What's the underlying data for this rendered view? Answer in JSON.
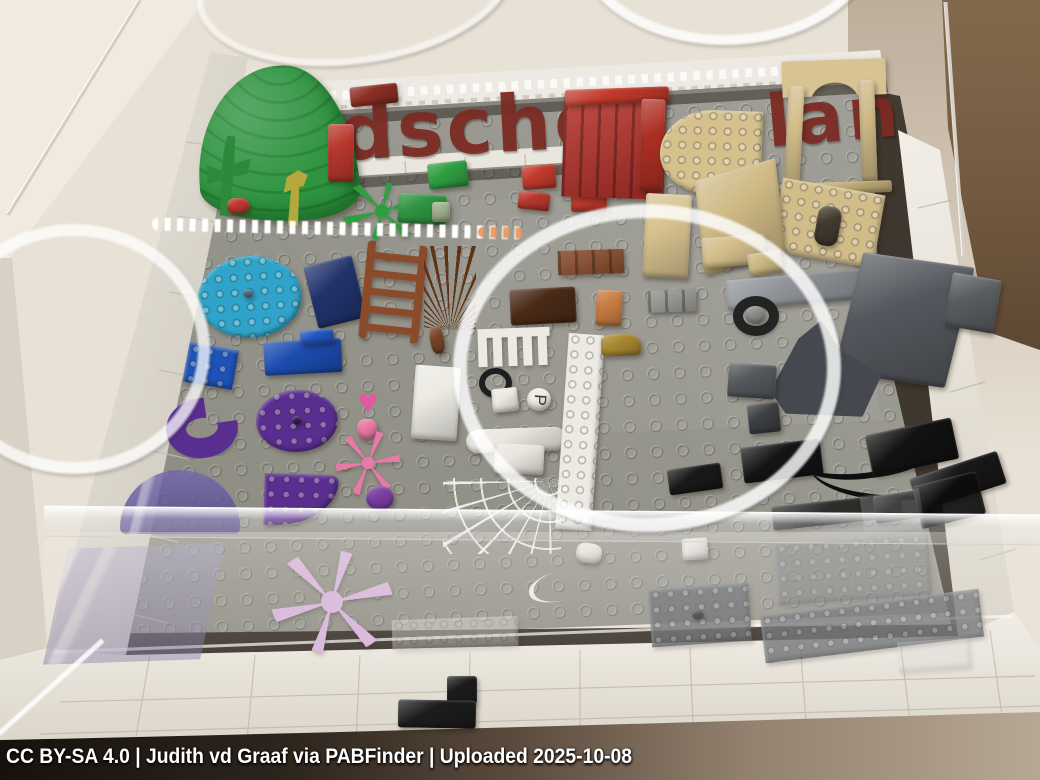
{
  "description": "Photograph of a LEGO Pick-a-Brick idea display table: a clear acrylic case over a gray studded baseplate framed in white bricks, holding loose LEGO elements grouped by color (green, red, tan, brown, blue, purple, pink, white, gray, black). Dark-red brick-built letters run along the back. Ceiling lights reflect as white rings on the acrylic.",
  "caption": {
    "text": "CC BY-SA 4.0 | Judith vd Graaf via PABFinder | Uploaded 2025-10-08"
  },
  "mosaic_letters": {
    "left": "dsche",
    "right": "lan",
    "color": "#7b2b22"
  },
  "palette": {
    "wall": "#e8e1d5",
    "wall_light": "#f0eadf",
    "apron": "#ece8e0",
    "apron_shade": "#d8d2c6",
    "baseplate": "#98978f",
    "baseplate_dark": "#86857c",
    "trench": "#342c23",
    "box_brown": "#7b6247",
    "box_brown_dark": "#573f2c",
    "border_white": "#edeae3",
    "acrylic_edge": "#d2cdc4",
    "floor_shadow": "#17120e",
    "floor_shadow_light": "#b7a795",
    "ring": "rgba(255,255,255,0.8)",
    "letters": "#7b2b22"
  },
  "acrylic_bar": {
    "x": 44,
    "y": 510,
    "w": 996,
    "h": 28,
    "haze_h": 130
  },
  "pieces": [
    {
      "name": "green-leaf-canopy",
      "kind": "dome",
      "x": 197,
      "y": 66,
      "w": 160,
      "h": 156,
      "c": "#2e9440",
      "r": "55% 45% 35% 65% / 75% 85% 18% 25%",
      "rot": -4
    },
    {
      "name": "green-cactus",
      "kind": "clip",
      "x": 206,
      "y": 136,
      "w": 44,
      "h": 80,
      "c": "#2c8a3a",
      "clip": "polygon(42% 0,60% 0,62% 34%,100% 26%,94% 46%,62% 50%,60% 100%,38% 100%,36% 56%,4% 62%,0 38%,34% 44%,38% 12%)",
      "rot": 4
    },
    {
      "name": "red-flower-piece",
      "kind": "block",
      "x": 227,
      "y": 198,
      "w": 22,
      "h": 16,
      "c": "#bf3b2d",
      "r": "40%"
    },
    {
      "name": "olive-sprout",
      "kind": "clip",
      "x": 277,
      "y": 170,
      "w": 36,
      "h": 56,
      "c": "#b5a93e",
      "clip": "polygon(55% 0,82% 8%,72% 28%,60% 30%,62% 100%,34% 100%,38% 36%,18% 42%,24% 14%)",
      "rot": 3
    },
    {
      "name": "green-plant-plate",
      "kind": "snow",
      "x": 340,
      "y": 182,
      "w": 84,
      "h": 58,
      "c": "#2f9e41",
      "rot": 8
    },
    {
      "name": "green-slope-brick",
      "kind": "block",
      "x": 428,
      "y": 162,
      "w": 40,
      "h": 26,
      "c": "#2f9e41",
      "rot": -6
    },
    {
      "name": "green-plate-cluster",
      "kind": "block",
      "x": 398,
      "y": 194,
      "w": 48,
      "h": 30,
      "c": "#2e9440",
      "rot": 4
    },
    {
      "name": "sand-green-brick",
      "kind": "block",
      "x": 432,
      "y": 202,
      "w": 18,
      "h": 20,
      "c": "#9fb08c"
    },
    {
      "name": "dark-red-plate",
      "kind": "block",
      "x": 350,
      "y": 85,
      "w": 48,
      "h": 20,
      "c": "#8a2f24",
      "rot": -6
    },
    {
      "name": "red-brick-stack-left",
      "kind": "block",
      "x": 328,
      "y": 124,
      "w": 26,
      "h": 58,
      "c": "#b7372b"
    },
    {
      "name": "red-slope-brick",
      "kind": "block",
      "x": 522,
      "y": 165,
      "w": 34,
      "h": 24,
      "c": "#c03a2c",
      "rot": -4
    },
    {
      "name": "red-small-bricks",
      "kind": "block",
      "x": 518,
      "y": 192,
      "w": 32,
      "h": 18,
      "c": "#b7372b",
      "rot": 6
    },
    {
      "name": "red-2x2-brick",
      "kind": "block",
      "x": 571,
      "y": 186,
      "w": 36,
      "h": 26,
      "c": "#c03a2c"
    },
    {
      "name": "red-panel-wall",
      "kind": "wall",
      "x": 563,
      "y": 96,
      "w": 102,
      "h": 102,
      "c": "#b52f27",
      "rot": 2
    },
    {
      "name": "red-wall-top-brick",
      "kind": "block",
      "x": 565,
      "y": 88,
      "w": 104,
      "h": 16,
      "c": "#c23a2b",
      "rot": -2
    },
    {
      "name": "red-brick-stack-right",
      "kind": "block",
      "x": 640,
      "y": 99,
      "w": 24,
      "h": 92,
      "c": "#ad2f24",
      "rot": 2
    },
    {
      "name": "tan-quarter-circle-plate",
      "kind": "flat",
      "x": 660,
      "y": 110,
      "w": 102,
      "h": 84,
      "c": "#d6c18e",
      "r": "100% 0 0 90%",
      "rot": 2,
      "studs": true
    },
    {
      "name": "tan-arch-lintel",
      "kind": "archtop",
      "x": 782,
      "y": 60,
      "w": 104,
      "h": 36,
      "c": "#d8c392",
      "rot": -2
    },
    {
      "name": "tan-arch-leg-left",
      "kind": "block",
      "x": 786,
      "y": 86,
      "w": 16,
      "h": 106,
      "c": "#d2bd8a",
      "rot": 3
    },
    {
      "name": "tan-arch-leg-right",
      "kind": "block",
      "x": 860,
      "y": 80,
      "w": 16,
      "h": 102,
      "c": "#cdb884",
      "rot": -2
    },
    {
      "name": "tan-arch-base-plate",
      "kind": "block",
      "x": 780,
      "y": 182,
      "w": 112,
      "h": 12,
      "c": "#cbb680",
      "rot": -2
    },
    {
      "name": "tan-window-panel",
      "kind": "flat",
      "x": 776,
      "y": 186,
      "w": 104,
      "h": 74,
      "c": "#d2bd8a",
      "rot": 10,
      "studs": true
    },
    {
      "name": "tan-window-slot",
      "kind": "block",
      "x": 816,
      "y": 206,
      "w": 24,
      "h": 40,
      "c": "#413a2e",
      "r": "10px",
      "rot": 10
    },
    {
      "name": "tan-wall-panel",
      "kind": "block",
      "x": 698,
      "y": 170,
      "w": 84,
      "h": 94,
      "c": "#cfba85",
      "tf": "rotate(-16deg) skewX(-10deg)"
    },
    {
      "name": "tan-brick-2x6",
      "kind": "block",
      "x": 644,
      "y": 194,
      "w": 46,
      "h": 84,
      "c": "#d6c18e",
      "rot": 3
    },
    {
      "name": "tan-brick-1x4-pair",
      "kind": "block",
      "x": 702,
      "y": 236,
      "w": 64,
      "h": 30,
      "c": "#d2bd8a",
      "rot": -4
    },
    {
      "name": "tan-brick-small",
      "kind": "block",
      "x": 748,
      "y": 252,
      "w": 34,
      "h": 22,
      "c": "#cdb884",
      "rot": -8
    },
    {
      "name": "masonry-brick",
      "kind": "wall",
      "x": 558,
      "y": 250,
      "w": 66,
      "h": 24,
      "c": "#8a4b2a",
      "rot": -2
    },
    {
      "name": "dark-brown-brick",
      "kind": "block",
      "x": 510,
      "y": 288,
      "w": 66,
      "h": 36,
      "c": "#4a2a17",
      "rot": -3
    },
    {
      "name": "nougat-brick-stack",
      "kind": "block",
      "x": 596,
      "y": 290,
      "w": 26,
      "h": 36,
      "c": "#c77c43",
      "rot": 2
    },
    {
      "name": "gray-masonry-brick",
      "kind": "wall",
      "x": 648,
      "y": 290,
      "w": 48,
      "h": 22,
      "c": "#9b9b96",
      "rot": -2
    },
    {
      "name": "teal-round-plate",
      "kind": "flat",
      "x": 198,
      "y": 256,
      "w": 104,
      "h": 82,
      "c": "#2fa3c9",
      "r": "50%",
      "rot": -4,
      "studs": true
    },
    {
      "name": "teal-plate-hole",
      "kind": "block",
      "x": 243,
      "y": 289,
      "w": 10,
      "h": 9,
      "c": "#55788a",
      "r": "50%"
    },
    {
      "name": "dark-blue-brick",
      "kind": "block",
      "x": 310,
      "y": 260,
      "w": 50,
      "h": 64,
      "c": "#20336b",
      "rot": -14
    },
    {
      "name": "brown-ladder",
      "kind": "ladder",
      "x": 363,
      "y": 243,
      "w": 60,
      "h": 98,
      "c": "#8a4b2a",
      "rot": 6
    },
    {
      "name": "brown-spiky-plant",
      "kind": "spiky",
      "x": 424,
      "y": 246,
      "w": 52,
      "h": 84,
      "c": "#5f3317"
    },
    {
      "name": "brown-stem",
      "kind": "block",
      "x": 430,
      "y": 326,
      "w": 14,
      "h": 28,
      "c": "#7a4526",
      "r": "40%",
      "rot": -10
    },
    {
      "name": "blue-plate-2x3",
      "kind": "flat",
      "x": 186,
      "y": 346,
      "w": 50,
      "h": 40,
      "c": "#1d52b8",
      "rot": 10,
      "studs": true
    },
    {
      "name": "blue-bracket-plate",
      "kind": "block",
      "x": 264,
      "y": 340,
      "w": 78,
      "h": 34,
      "c": "#1c4cb0",
      "rot": -3
    },
    {
      "name": "blue-bracket-studs",
      "kind": "block",
      "x": 300,
      "y": 330,
      "w": 34,
      "h": 14,
      "c": "#2457c4",
      "rot": -3
    },
    {
      "name": "purple-round-plate",
      "kind": "flat",
      "x": 256,
      "y": 390,
      "w": 82,
      "h": 62,
      "c": "#5a2d90",
      "r": "50%",
      "rot": -3,
      "studs": true
    },
    {
      "name": "purple-plate-hole",
      "kind": "block",
      "x": 292,
      "y": 416,
      "w": 10,
      "h": 9,
      "c": "#3a1f5e",
      "r": "50%"
    },
    {
      "name": "pink-heart-tile",
      "kind": "glyph",
      "x": 350,
      "y": 384,
      "w": 36,
      "h": 36,
      "c": "#e05aa3",
      "glyph": "♥",
      "fs": 34
    },
    {
      "name": "pink-cone",
      "kind": "block",
      "x": 357,
      "y": 419,
      "w": 20,
      "h": 21,
      "c": "#e87ba5",
      "r": "40% 40% 45% 45%"
    },
    {
      "name": "purple-macaroni-brick",
      "kind": "ring",
      "x": 166,
      "y": 398,
      "w": 72,
      "h": 60,
      "c": "#5a2d90",
      "bw": 20,
      "clip": "polygon(0 0,58% 0,58% 45%,100% 45%,100% 100%,0 100%)",
      "rot": -8
    },
    {
      "name": "purple-quarter-plate",
      "kind": "flat",
      "x": 264,
      "y": 474,
      "w": 74,
      "h": 52,
      "c": "#5a2d90",
      "r": "0 14% 100% 0",
      "rot": 2,
      "studs": true
    },
    {
      "name": "pink-coral-plant",
      "kind": "snow",
      "x": 336,
      "y": 430,
      "w": 64,
      "h": 66,
      "c": "#e87aa8",
      "rot": 15
    },
    {
      "name": "purple-round-1x1",
      "kind": "block",
      "x": 366,
      "y": 486,
      "w": 28,
      "h": 24,
      "c": "#7b3fa2",
      "r": "50%"
    },
    {
      "name": "trans-purple-windscreen",
      "kind": "glass",
      "x": 120,
      "y": 470,
      "w": 120,
      "h": 64,
      "c": "#5a4da1",
      "op": 0.78,
      "r": "50% 50% 6px 6px / 90% 90% 6px 6px"
    },
    {
      "name": "trans-purple-panel",
      "kind": "glass",
      "x": 56,
      "y": 546,
      "w": 156,
      "h": 116,
      "c": "#8f86bb",
      "op": 0.45,
      "tf": "skewX(-14deg) rotate(-2deg)"
    },
    {
      "name": "lavender-snowflake-plant",
      "kind": "snow",
      "x": 270,
      "y": 550,
      "w": 124,
      "h": 104,
      "c": "#d8b2dc",
      "rot": 10
    },
    {
      "name": "white-brick-2x4",
      "kind": "block",
      "x": 413,
      "y": 366,
      "w": 46,
      "h": 74,
      "c": "#eceae3",
      "rot": 4
    },
    {
      "name": "white-picket-fence",
      "kind": "fence",
      "x": 478,
      "y": 328,
      "w": 72,
      "h": 38,
      "c": "#edeae3",
      "rot": -2
    },
    {
      "name": "black-steering-wheel",
      "kind": "ring",
      "x": 479,
      "y": 368,
      "w": 33,
      "h": 30,
      "c": "#1e1e1e",
      "bw": 6
    },
    {
      "name": "white-small-tiles",
      "kind": "block",
      "x": 492,
      "y": 388,
      "w": 26,
      "h": 24,
      "c": "#edeae3",
      "rot": -6
    },
    {
      "name": "white-round-letter-tile",
      "kind": "block",
      "x": 527,
      "y": 388,
      "w": 24,
      "h": 23,
      "c": "#f0ede6",
      "r": "50%"
    },
    {
      "name": "letter-tile-glyph",
      "kind": "glyph",
      "x": 529,
      "y": 389,
      "w": 21,
      "h": 22,
      "c": "#3b3b39",
      "glyph": "P",
      "fs": 17,
      "rot": 95
    },
    {
      "name": "white-bone",
      "kind": "block",
      "x": 466,
      "y": 428,
      "w": 100,
      "h": 24,
      "c": "#eae7e0",
      "r": "12px",
      "rot": -2
    },
    {
      "name": "white-brick-pair",
      "kind": "block",
      "x": 494,
      "y": 444,
      "w": 50,
      "h": 30,
      "c": "#e9e6df",
      "rot": 3
    },
    {
      "name": "white-brick-1x10",
      "kind": "flat",
      "x": 562,
      "y": 334,
      "w": 36,
      "h": 196,
      "c": "#eceae3",
      "rot": 4,
      "studs": true
    },
    {
      "name": "gold-mini-vehicle",
      "kind": "block",
      "x": 601,
      "y": 334,
      "w": 40,
      "h": 22,
      "c": "#a8872f",
      "r": "30% 45% 20% 20%",
      "rot": -2
    },
    {
      "name": "white-spider-web",
      "kind": "web",
      "x": 443,
      "y": 478,
      "w": 118,
      "h": 76,
      "op": 0.92,
      "c": "#ffffff"
    },
    {
      "name": "black-wedge-plate",
      "kind": "block",
      "x": 668,
      "y": 466,
      "w": 54,
      "h": 26,
      "c": "#191919",
      "rot": -8
    },
    {
      "name": "white-plate-1x1",
      "kind": "block",
      "x": 682,
      "y": 538,
      "w": 26,
      "h": 22,
      "c": "#e9e6e0",
      "rot": -4
    },
    {
      "name": "white-clip-piece",
      "kind": "block",
      "x": 576,
      "y": 543,
      "w": 26,
      "h": 20,
      "c": "#e9e6e0",
      "r": "40%",
      "rot": 10
    },
    {
      "name": "white-string-whip",
      "kind": "whip",
      "x": 548,
      "y": 550,
      "w": 30,
      "h": 70,
      "c": "#efece6",
      "bw": 5,
      "rot": 75
    },
    {
      "name": "gray-plate-long",
      "kind": "block",
      "x": 726,
      "y": 274,
      "w": 152,
      "h": 30,
      "c": "#8d9196",
      "rot": -5
    },
    {
      "name": "wheel-tire",
      "kind": "ring",
      "x": 733,
      "y": 296,
      "w": 46,
      "h": 40,
      "c": "#232323",
      "bw": 10
    },
    {
      "name": "wheel-hub",
      "kind": "block",
      "x": 745,
      "y": 306,
      "w": 20,
      "h": 18,
      "c": "#8e8e8a",
      "r": "50%"
    },
    {
      "name": "dark-gray-slope-panel",
      "kind": "block",
      "x": 848,
      "y": 258,
      "w": 112,
      "h": 124,
      "c": "#54575d",
      "tf": "rotate(14deg) skewY(-6deg)"
    },
    {
      "name": "dark-gray-rock",
      "kind": "clip",
      "x": 760,
      "y": 318,
      "w": 128,
      "h": 104,
      "c": "#45484e",
      "clip": "polygon(8% 70%,30% 20%,48% 2%,62% 30%,95% 55%,80% 95%,20% 92%)"
    },
    {
      "name": "dark-gray-bricks",
      "kind": "block",
      "x": 728,
      "y": 364,
      "w": 48,
      "h": 34,
      "c": "#54575b",
      "rot": 4
    },
    {
      "name": "dark-gray-1x1s",
      "kind": "block",
      "x": 748,
      "y": 403,
      "w": 32,
      "h": 30,
      "c": "#3c3f43",
      "rot": -6
    },
    {
      "name": "dark-gray-edge-brick",
      "kind": "block",
      "x": 948,
      "y": 276,
      "w": 50,
      "h": 54,
      "c": "#595c60",
      "rot": 10
    },
    {
      "name": "black-plate-row",
      "kind": "block",
      "x": 742,
      "y": 443,
      "w": 80,
      "h": 36,
      "c": "#141414",
      "rot": -7
    },
    {
      "name": "black-whip-long",
      "kind": "whip",
      "x": 790,
      "y": 408,
      "w": 160,
      "h": 70,
      "c": "#0f0f0f",
      "bw": 6,
      "rot": -8
    },
    {
      "name": "black-whip-short",
      "kind": "whip",
      "x": 810,
      "y": 440,
      "w": 150,
      "h": 60,
      "c": "#0f0f0f",
      "bw": 5,
      "rot": 4
    },
    {
      "name": "black-plate-mid",
      "kind": "block",
      "x": 868,
      "y": 426,
      "w": 88,
      "h": 42,
      "c": "#121212",
      "rot": -12
    },
    {
      "name": "black-plate-edge",
      "kind": "block",
      "x": 912,
      "y": 464,
      "w": 92,
      "h": 34,
      "c": "#181818",
      "rot": -18
    },
    {
      "name": "black-plates-lower",
      "kind": "block",
      "x": 772,
      "y": 500,
      "w": 130,
      "h": 24,
      "c": "#1b1b1b",
      "op": 0.85,
      "rot": -6
    },
    {
      "name": "black-2x2-lower",
      "kind": "block",
      "x": 874,
      "y": 492,
      "w": 58,
      "h": 28,
      "c": "#141414",
      "op": 0.85,
      "rot": -8
    },
    {
      "name": "black-plate-corner",
      "kind": "block",
      "x": 916,
      "y": 478,
      "w": 66,
      "h": 44,
      "c": "#0d0d0d",
      "op": 0.9,
      "rot": -14
    },
    {
      "name": "trans-clear-plate",
      "kind": "flat",
      "x": 392,
      "y": 618,
      "w": 126,
      "h": 30,
      "c": "#e8e6e1",
      "op": 0.4,
      "rot": -2,
      "studs": true
    },
    {
      "name": "ghost-gray-plate-wide",
      "kind": "flat",
      "x": 776,
      "y": 538,
      "w": 154,
      "h": 62,
      "c": "#70737a",
      "op": 0.5,
      "rot": -4,
      "studs": true
    },
    {
      "name": "gray-plate-with-hole",
      "kind": "flat",
      "x": 650,
      "y": 586,
      "w": 100,
      "h": 58,
      "c": "#5f6369",
      "op": 0.8,
      "rot": -4,
      "studs": true
    },
    {
      "name": "gray-plate-hole-dot",
      "kind": "block",
      "x": 692,
      "y": 610,
      "w": 12,
      "h": 10,
      "c": "#2e3135",
      "r": "50%",
      "op": 0.8
    },
    {
      "name": "gray-plate-long-bottom",
      "kind": "flat",
      "x": 762,
      "y": 602,
      "w": 220,
      "h": 48,
      "c": "#63666c",
      "op": 0.8,
      "rot": -7,
      "studs": true
    },
    {
      "name": "ghost-clear-brick",
      "kind": "flat",
      "x": 862,
      "y": 492,
      "w": 60,
      "h": 40,
      "c": "#cfd0d2",
      "op": 0.22,
      "rot": -8
    },
    {
      "name": "ghost-clear-tile",
      "kind": "flat",
      "x": 898,
      "y": 640,
      "w": 72,
      "h": 30,
      "c": "#d8d8da",
      "op": 0.3,
      "rot": -4
    },
    {
      "name": "black-border-brick-top",
      "kind": "block",
      "x": 447,
      "y": 676,
      "w": 30,
      "h": 28,
      "c": "#1c1c1c"
    },
    {
      "name": "black-border-brick-bottom",
      "kind": "block",
      "x": 398,
      "y": 700,
      "w": 78,
      "h": 28,
      "c": "#1c1c1c",
      "rot": 1
    }
  ],
  "reflections": [
    {
      "name": "light-ring-left",
      "kind": "ring",
      "x": -62,
      "y": 224,
      "w": 272,
      "h": 250,
      "c": "rgba(255,255,255,0.75)",
      "bw": 12,
      "blur": 1
    },
    {
      "name": "light-ring-center",
      "kind": "ring",
      "x": 453,
      "y": 204,
      "w": 388,
      "h": 328,
      "c": "rgba(255,255,255,0.82)",
      "bw": 14,
      "blur": 1
    },
    {
      "name": "light-arc-top-center",
      "kind": "ring",
      "x": 575,
      "y": -160,
      "w": 300,
      "h": 205,
      "c": "rgba(255,255,255,0.8)",
      "bw": 10,
      "blur": 1
    },
    {
      "name": "light-arc-top-left",
      "kind": "ring",
      "x": 195,
      "y": -98,
      "w": 320,
      "h": 162,
      "c": "rgba(255,255,255,0.55)",
      "bw": 7,
      "rot": -8,
      "blur": 1
    },
    {
      "name": "stud-sparkle-strip",
      "kind": "dots",
      "x": 152,
      "y": 222,
      "w": 370,
      "h": 13,
      "c": "#ffffff",
      "rot": 1.4,
      "blur": 0.4
    },
    {
      "name": "stud-sparkle-orange",
      "kind": "dots",
      "x": 478,
      "y": 227,
      "w": 46,
      "h": 11,
      "c": "#e8935a",
      "rot": 1.4,
      "op": 0.9,
      "blur": 0.4
    },
    {
      "name": "acrylic-edge-glint",
      "kind": "line",
      "x": -28,
      "y": 688,
      "w": 150,
      "h": 5,
      "c": "rgba(255,255,255,0.85)",
      "rot": -42,
      "blur": 0.5
    }
  ]
}
